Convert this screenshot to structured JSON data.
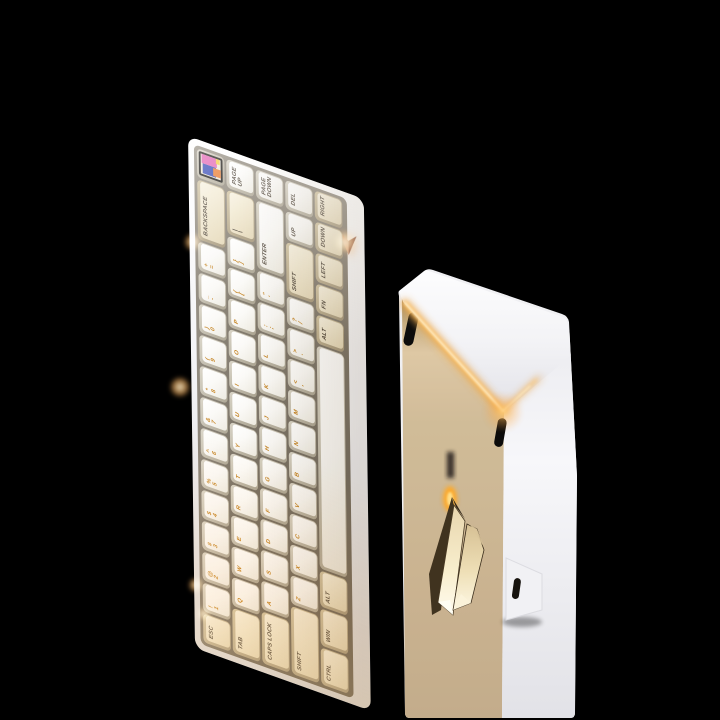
{
  "scene": {
    "background": "#000000"
  },
  "keyboard_front": {
    "badge": {
      "icon": "pixel-art-badge",
      "colors": {
        "frame": "#15130f",
        "screen": "#efe8d6",
        "blue": "#3246b4",
        "pink": "#e160b2",
        "orange": "#e9792d",
        "yellow": "#f2cb3e"
      }
    },
    "side_logo": {
      "icon": "paper-plane-icon",
      "color_light": "#dfa078",
      "color_dark": "#8c4e36"
    },
    "colors": {
      "case": "#f4f4f6",
      "key_white_top": "#fcfbf8",
      "key_cream_top": "#efe6cc",
      "legend_orange": "#c4801c",
      "legend_dark": "#4d4337",
      "backlight_glow": "#ffcf7e"
    },
    "rows": [
      {
        "keys": [
          {
            "id": "esc",
            "main": "ESC",
            "w": 1,
            "cap": "cream",
            "ink": "dark"
          },
          {
            "id": "1",
            "shift": "!",
            "main": "1"
          },
          {
            "id": "2",
            "shift": "@",
            "main": "2"
          },
          {
            "id": "3",
            "shift": "#",
            "main": "3"
          },
          {
            "id": "4",
            "shift": "$",
            "main": "4"
          },
          {
            "id": "5",
            "shift": "%",
            "main": "5"
          },
          {
            "id": "6",
            "shift": "^",
            "main": "6"
          },
          {
            "id": "7",
            "shift": "&",
            "main": "7"
          },
          {
            "id": "8",
            "shift": "*",
            "main": "8"
          },
          {
            "id": "9",
            "shift": "(",
            "main": "9"
          },
          {
            "id": "0",
            "shift": ")",
            "main": "0"
          },
          {
            "id": "minus",
            "shift": "_",
            "main": "-"
          },
          {
            "id": "equals",
            "shift": "+",
            "main": "="
          },
          {
            "id": "backspace",
            "main": "BACKSPACE",
            "w": 2,
            "cap": "cream",
            "ink": "dark"
          },
          {
            "id": "badge",
            "w": 1
          }
        ]
      },
      {
        "keys": [
          {
            "id": "tab",
            "main": "TAB",
            "w": 1.5,
            "cap": "cream",
            "ink": "dark"
          },
          {
            "id": "q",
            "main": "Q"
          },
          {
            "id": "w",
            "main": "W"
          },
          {
            "id": "e",
            "main": "E"
          },
          {
            "id": "r",
            "main": "R"
          },
          {
            "id": "t",
            "main": "T"
          },
          {
            "id": "y",
            "main": "Y"
          },
          {
            "id": "u",
            "main": "U"
          },
          {
            "id": "i",
            "main": "I"
          },
          {
            "id": "o",
            "main": "O"
          },
          {
            "id": "p",
            "main": "P"
          },
          {
            "id": "lbracket",
            "shift": "{",
            "main": "["
          },
          {
            "id": "rbracket",
            "shift": "}",
            "main": "]"
          },
          {
            "id": "backslash",
            "shift": "|",
            "main": "\\",
            "w": 1.5,
            "cap": "cream",
            "ink": "dark"
          },
          {
            "id": "pageup",
            "main": "PAGE UP",
            "ink": "dark"
          }
        ]
      },
      {
        "keys": [
          {
            "id": "capslock",
            "main": "CAPS LOCK",
            "w": 1.75,
            "cap": "cream",
            "ink": "dark"
          },
          {
            "id": "a",
            "main": "A"
          },
          {
            "id": "s",
            "main": "S"
          },
          {
            "id": "d",
            "main": "D"
          },
          {
            "id": "f",
            "main": "F"
          },
          {
            "id": "g",
            "main": "G"
          },
          {
            "id": "h",
            "main": "H"
          },
          {
            "id": "j",
            "main": "J"
          },
          {
            "id": "k",
            "main": "K"
          },
          {
            "id": "l",
            "main": "L"
          },
          {
            "id": "semicolon",
            "shift": ":",
            "main": ";"
          },
          {
            "id": "quote",
            "shift": "\"",
            "main": "'"
          },
          {
            "id": "enter",
            "main": "ENTER",
            "w": 2.25,
            "ink": "dark"
          },
          {
            "id": "pagedown",
            "main": "PAGE DOWN",
            "ink": "dark"
          }
        ]
      },
      {
        "keys": [
          {
            "id": "lshift",
            "main": "SHIFT",
            "w": 2.25,
            "cap": "cream",
            "ink": "dark"
          },
          {
            "id": "z",
            "main": "Z"
          },
          {
            "id": "x",
            "main": "X"
          },
          {
            "id": "c",
            "main": "C"
          },
          {
            "id": "v",
            "main": "V"
          },
          {
            "id": "b",
            "main": "B"
          },
          {
            "id": "n",
            "main": "N"
          },
          {
            "id": "m",
            "main": "M"
          },
          {
            "id": "comma",
            "shift": "<",
            "main": ","
          },
          {
            "id": "period",
            "shift": ">",
            "main": "."
          },
          {
            "id": "slash",
            "shift": "?",
            "main": "/"
          },
          {
            "id": "rshift",
            "main": "SHIFT",
            "w": 1.75,
            "cap": "cream",
            "ink": "dark"
          },
          {
            "id": "up",
            "main": "UP",
            "ink": "dark"
          },
          {
            "id": "del",
            "main": "DEL",
            "ink": "dark"
          }
        ]
      },
      {
        "keys": [
          {
            "id": "ctrl",
            "main": "CTRL",
            "w": 1.25,
            "cap": "cream",
            "ink": "dark"
          },
          {
            "id": "win",
            "main": "WIN",
            "w": 1.25,
            "cap": "cream",
            "ink": "dark"
          },
          {
            "id": "lalt",
            "main": "ALT",
            "w": 1.25,
            "cap": "cream",
            "ink": "dark"
          },
          {
            "id": "space",
            "main": "",
            "w": 7.25
          },
          {
            "id": "ralt",
            "main": "ALT",
            "w": 1,
            "cap": "cream",
            "ink": "dark"
          },
          {
            "id": "fn",
            "main": "FN",
            "w": 1,
            "cap": "cream",
            "ink": "dark"
          },
          {
            "id": "left",
            "main": "LEFT",
            "w": 1,
            "cap": "cream",
            "ink": "dark"
          },
          {
            "id": "down",
            "main": "DOWN",
            "w": 1,
            "cap": "cream",
            "ink": "dark"
          },
          {
            "id": "right",
            "main": "RIGHT",
            "w": 1,
            "cap": "cream",
            "ink": "dark"
          }
        ]
      }
    ]
  },
  "keyboard_back": {
    "colors": {
      "case": "#f2f2f5",
      "gold_plate": "#c8b28c",
      "led_glow": "#ffc25e",
      "logo_gold": "#f3e8c6"
    },
    "logo": {
      "icon": "paper-plane-logo"
    }
  }
}
